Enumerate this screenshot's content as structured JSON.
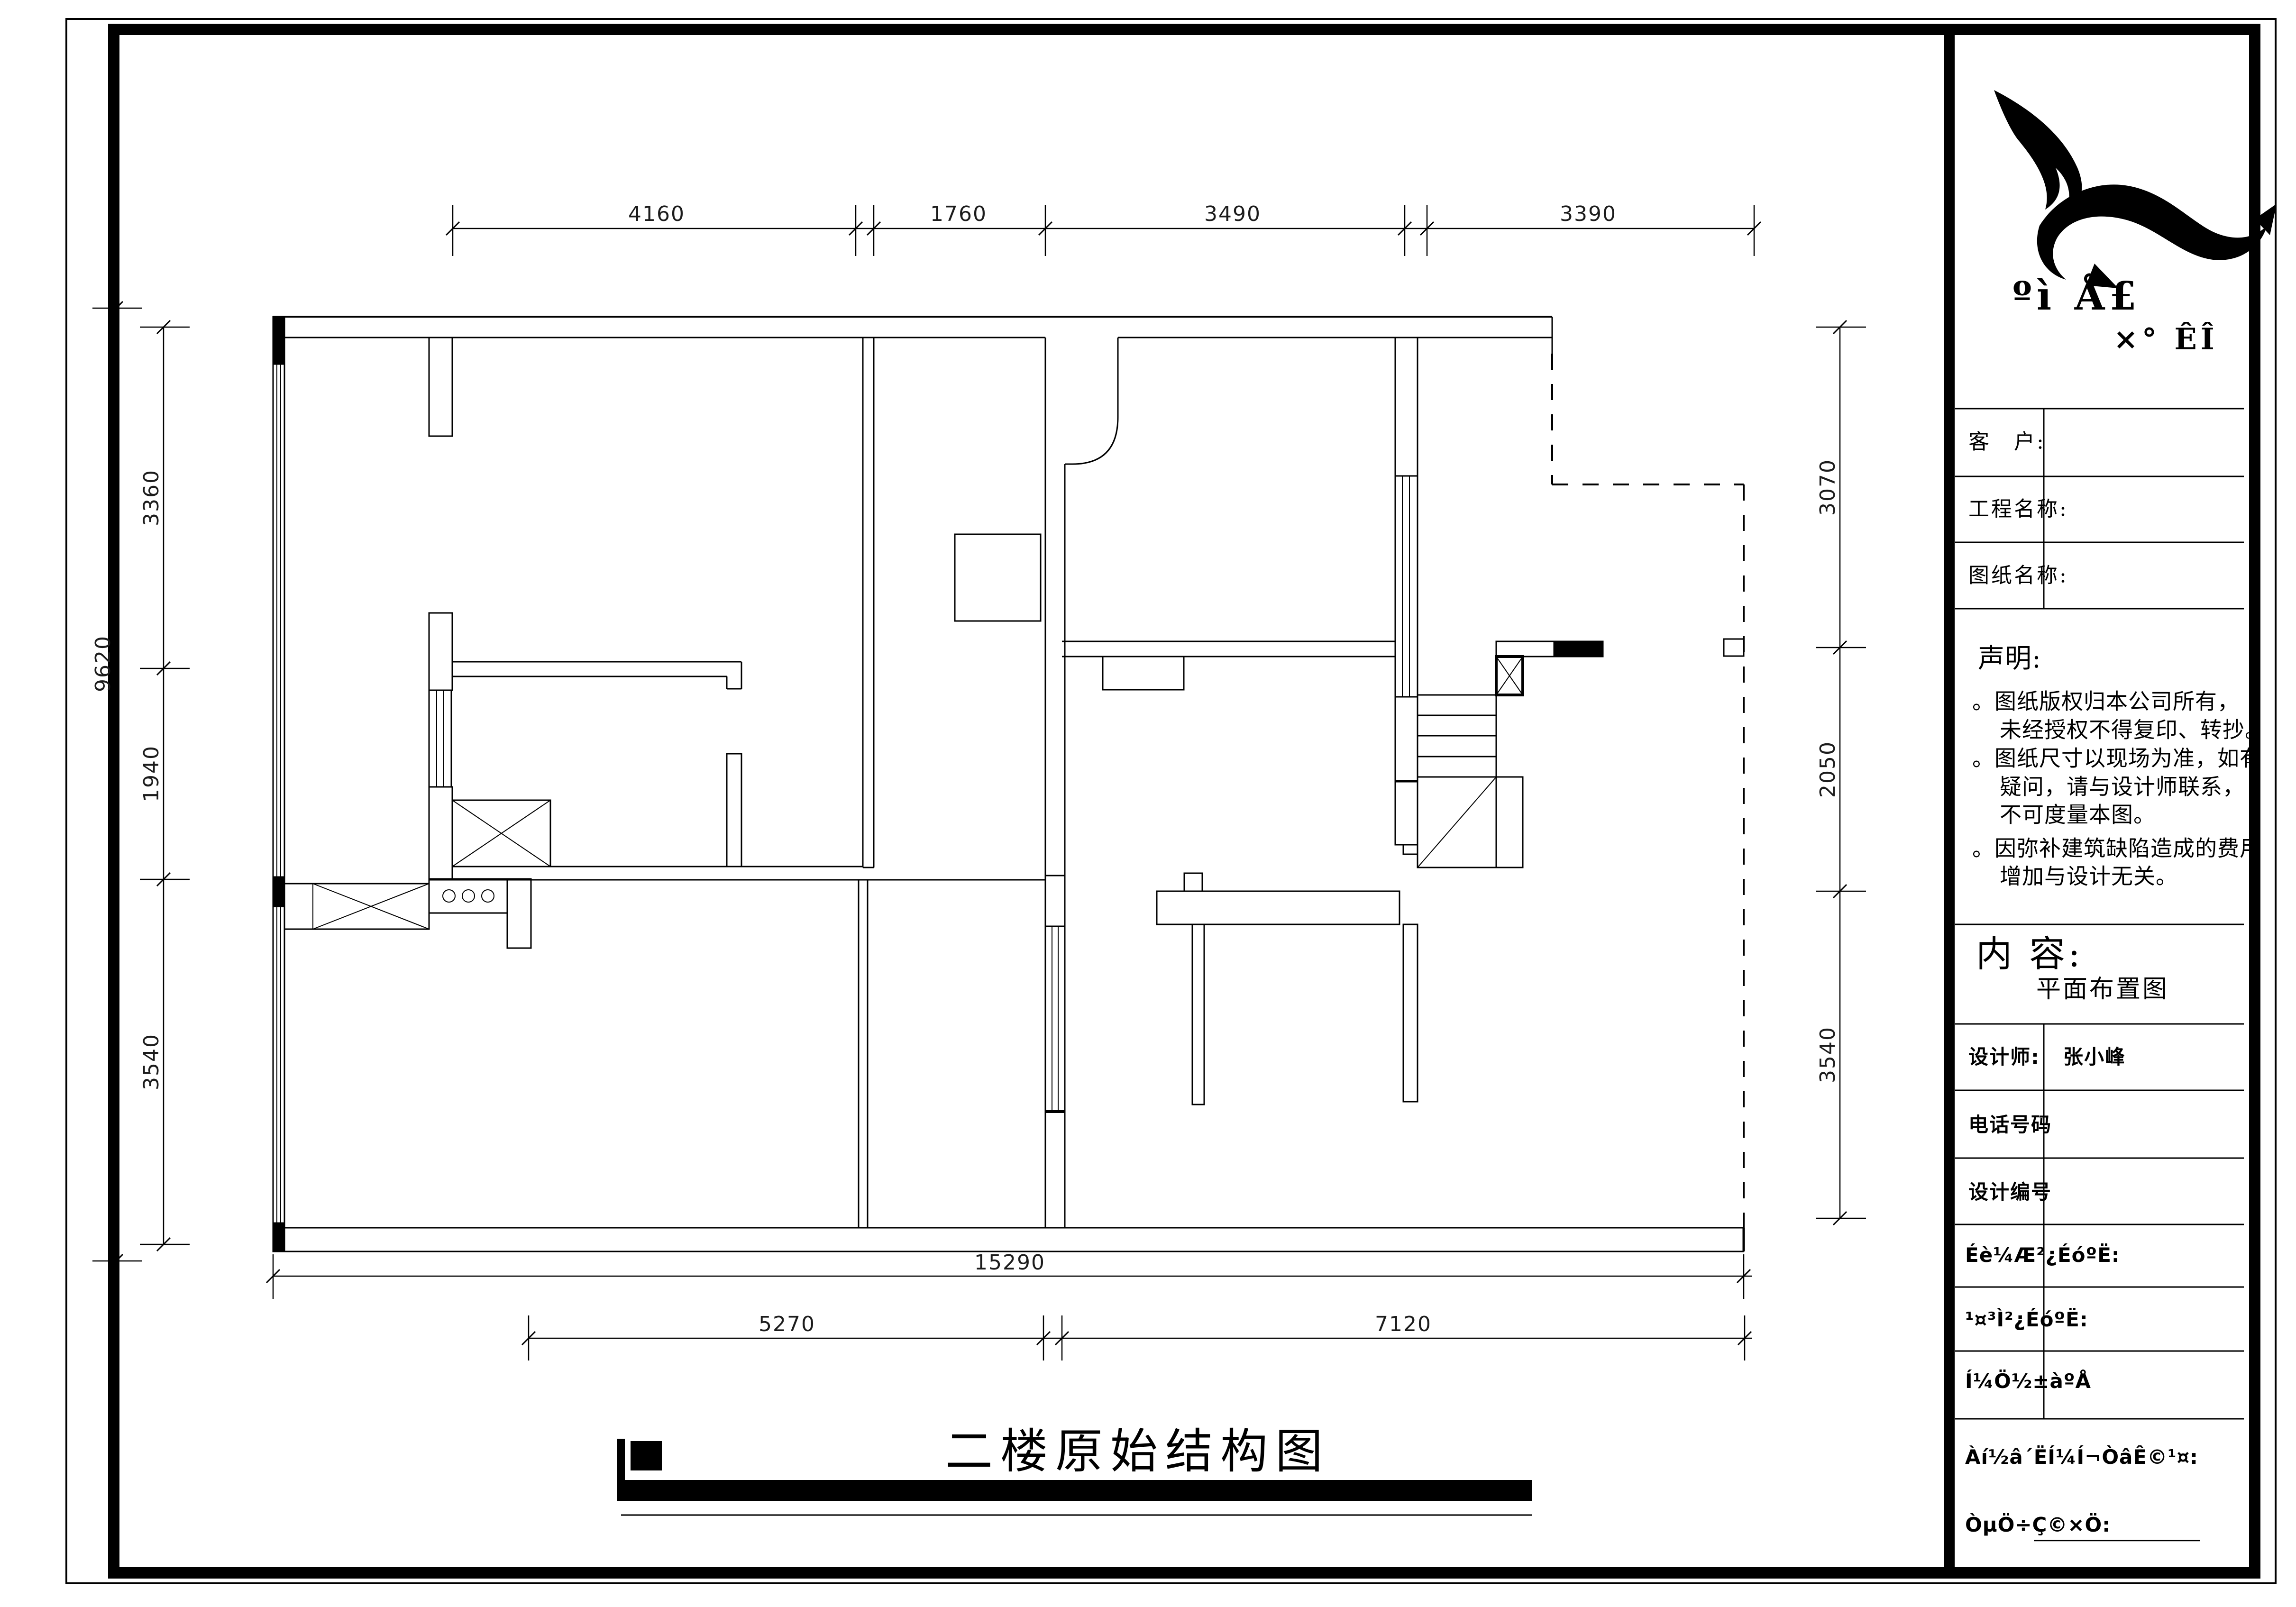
{
  "drawing": {
    "sheet_type": "architectural-floor-plan",
    "title": "二楼原始结构图",
    "dims": {
      "top": [
        "4160",
        "1760",
        "3490",
        "3390"
      ],
      "left_overall": "9620",
      "left": [
        "3360",
        "1940",
        "3540"
      ],
      "right": [
        "3070",
        "2050",
        "3540"
      ],
      "bottom_overall": "15290",
      "bottom": [
        "5270",
        "7120"
      ]
    }
  },
  "panel": {
    "icons": {
      "logo": "brand-swoosh"
    },
    "logo_text_line1": "ºì Å£",
    "logo_text_line2": "×° ÊÎ",
    "fields": {
      "customer_label": "客　户:",
      "project_label": "工程名称:",
      "sheet_label": "图纸名称:",
      "customer_value": "",
      "project_value": "",
      "sheet_value": ""
    },
    "statement": {
      "heading": "声明:",
      "line1a": "。图纸版权归本公司所有，",
      "line1b": "未经授权不得复印、转抄。",
      "line2a": "。图纸尺寸以现场为准，如有",
      "line2b": "疑问，请与设计师联系，",
      "line2c": "不可度量本图。",
      "line3a": "。因弥补建筑缺陷造成的费用",
      "line3b": "增加与设计无关。"
    },
    "content": {
      "heading": "内  容:",
      "value": "平面布置图"
    },
    "designer": {
      "label": "设计师:",
      "value": "张小峰"
    },
    "phone": {
      "label": "电话号码",
      "value": ""
    },
    "design_no": {
      "label": "设计编号",
      "value": ""
    },
    "review1_label": "Éè¼Æ²¿ÉóºË:",
    "review2_label": "¹¤³Ì²¿ÉóºË:",
    "sheet_no_label": "Í¼Ö½±àºÅ",
    "agree_label": "Àí½â´ËÍ¼Í¬ÒâÊ©¹¤:",
    "owner_sign_label": "ÒµÖ÷Ç©×Ö:"
  }
}
